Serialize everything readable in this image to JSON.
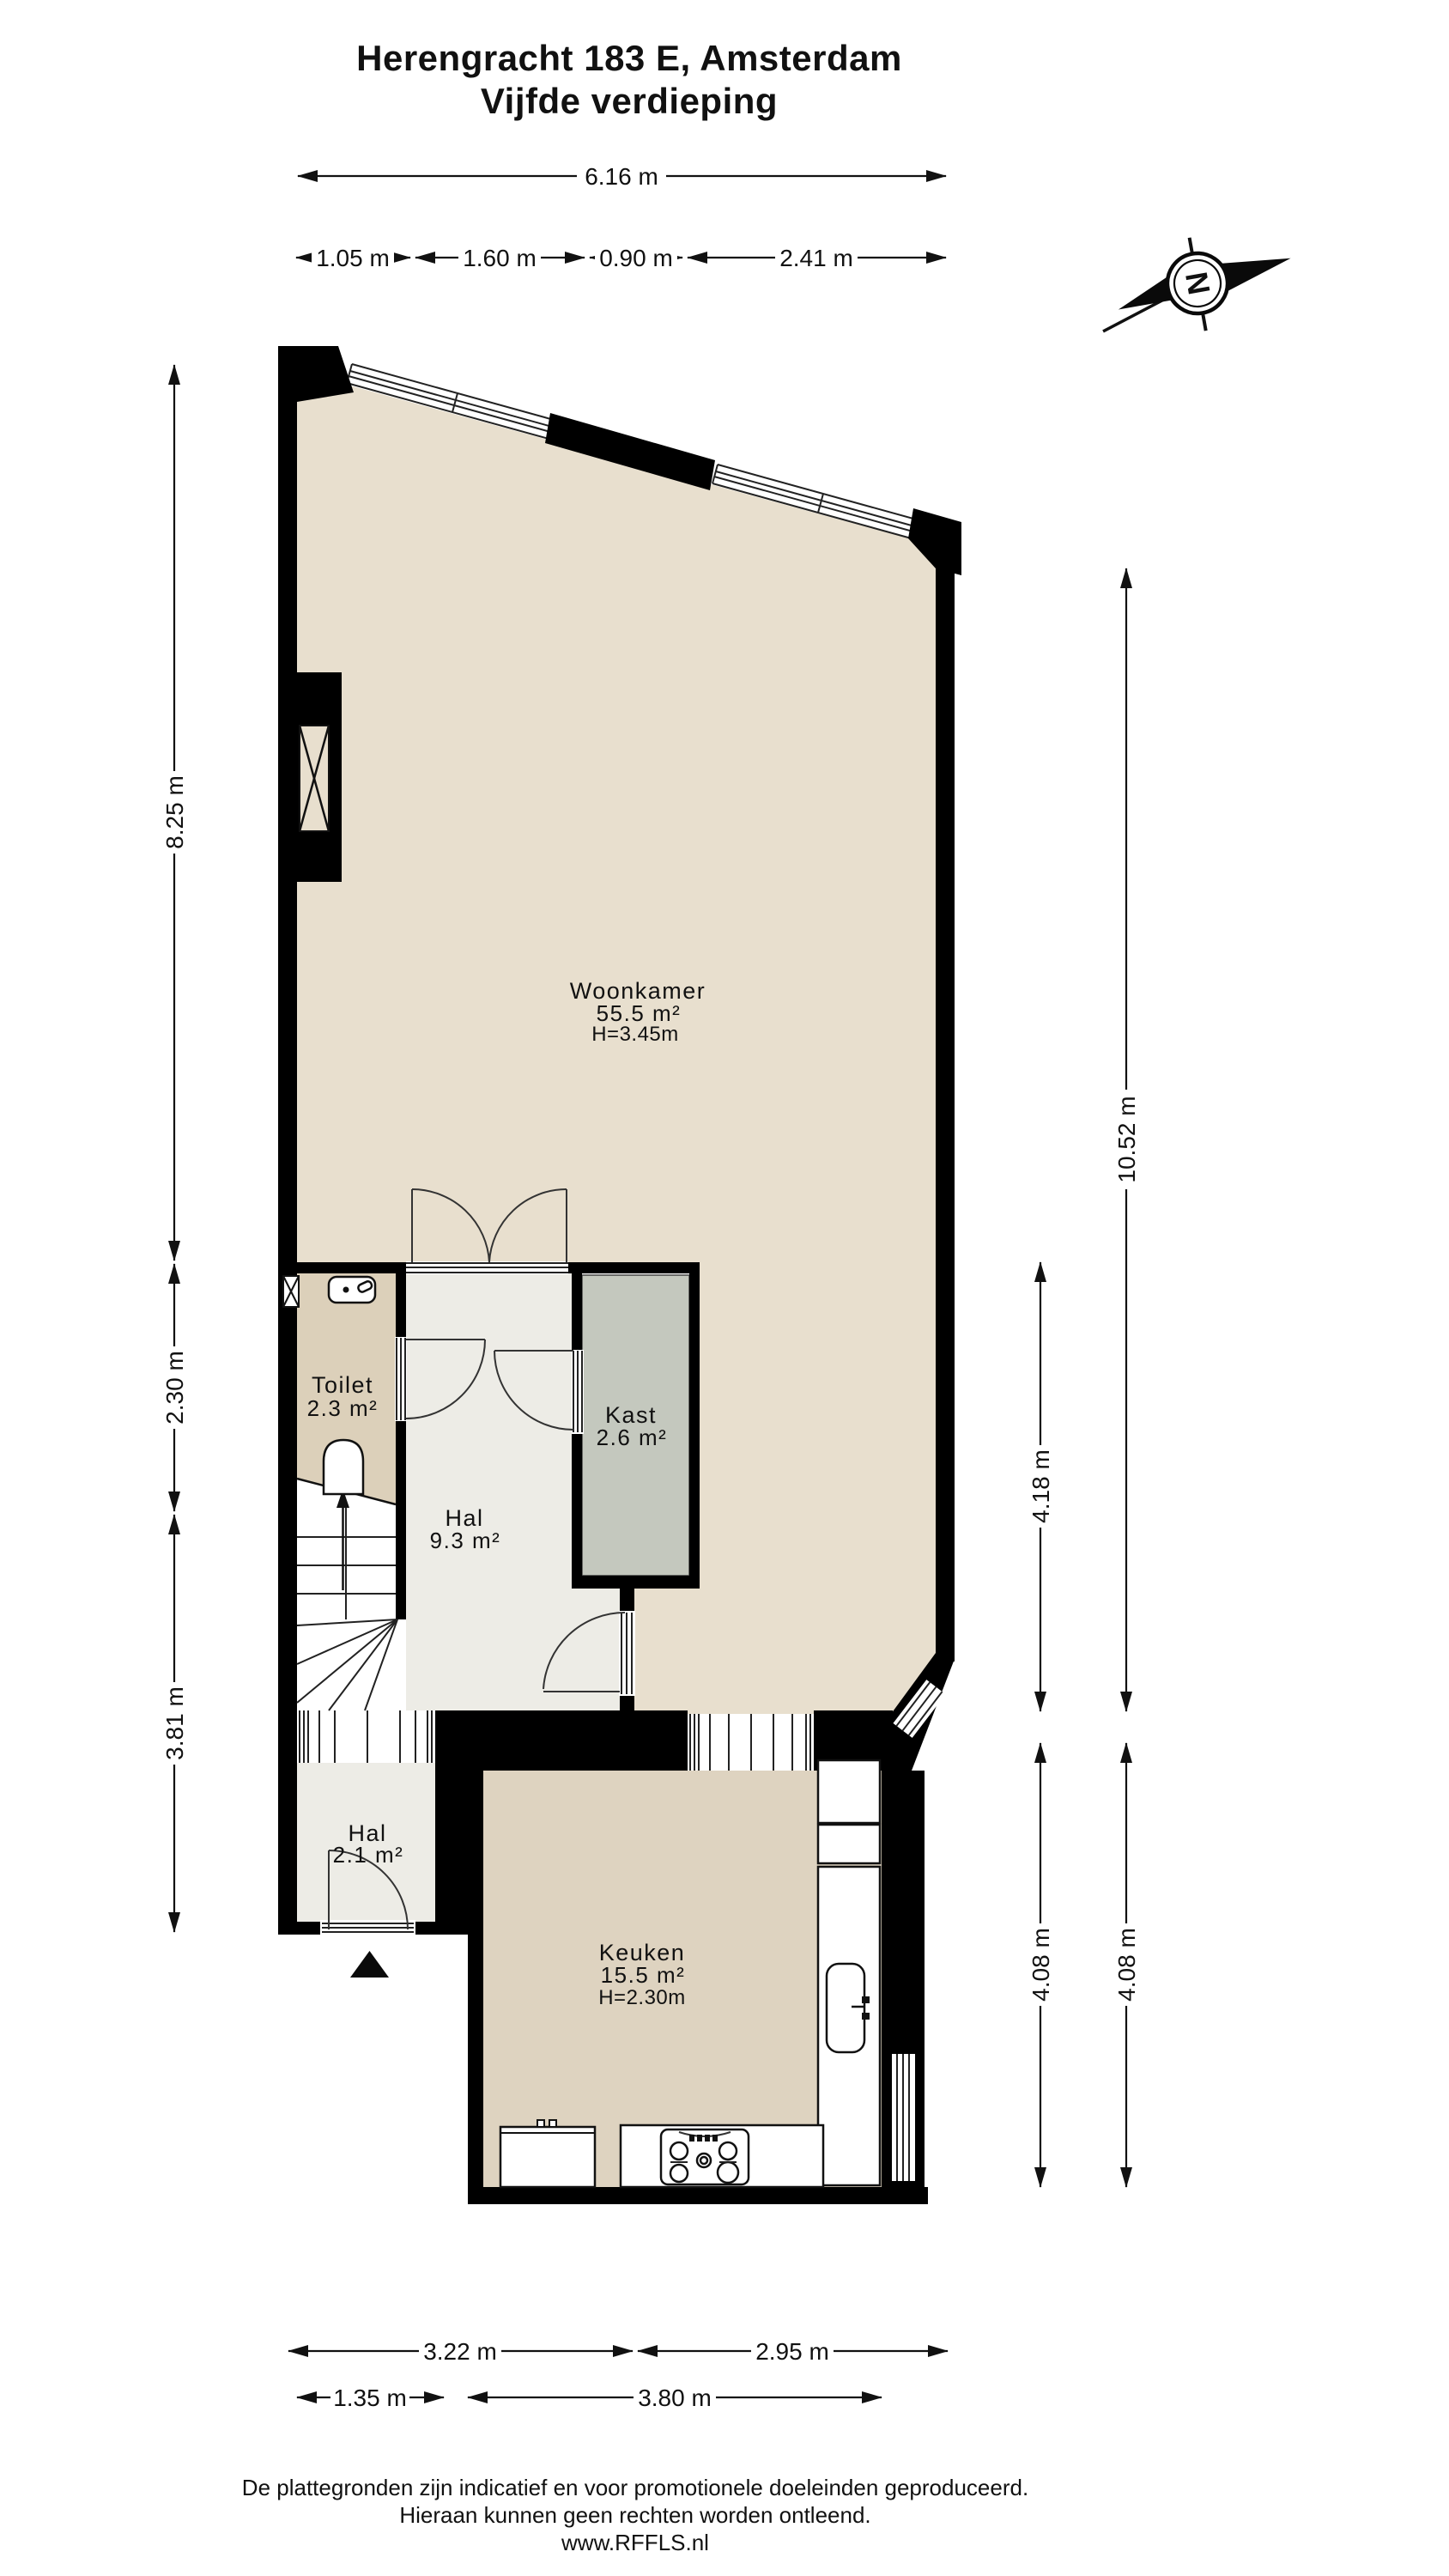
{
  "title": {
    "line1": "Herengracht 183 E, Amsterdam",
    "line2": "Vijfde verdieping"
  },
  "compass": {
    "north_letter": "N"
  },
  "rooms": {
    "woonkamer": {
      "name": "Woonkamer",
      "area": "55.5 m²",
      "ceiling": "H=3.45m"
    },
    "toilet": {
      "name": "Toilet",
      "area": "2.3 m²"
    },
    "kast": {
      "name": "Kast",
      "area": "2.6 m²"
    },
    "hal": {
      "name": "Hal",
      "area": "9.3 m²"
    },
    "hal2": {
      "name": "Hal",
      "area": "2.1 m²"
    },
    "keuken": {
      "name": "Keuken",
      "area": "15.5 m²",
      "ceiling": "H=2.30m"
    }
  },
  "dimensions": {
    "top_total": "6.16 m",
    "top_seg1": "1.05 m",
    "top_seg2": "1.60 m",
    "top_seg3": "0.90 m",
    "top_seg4": "2.41 m",
    "left_top": "8.25 m",
    "left_mid": "2.30 m",
    "left_bottom": "3.81 m",
    "right_total": "10.52 m",
    "right_mid": "4.18 m",
    "right_kitchen_inner": "4.08 m",
    "right_kitchen_outer": "4.08 m",
    "bottom_left": "3.22 m",
    "bottom_right": "2.95 m",
    "bottom_left2": "1.35 m",
    "bottom_right2": "3.80 m"
  },
  "footer": {
    "line1": "De plattegronden zijn indicatief en voor promotionele doeleinden geproduceerd.",
    "line2": "Hieraan kunnen geen rechten worden ontleend.",
    "line3": "www.RFFLS.nl"
  },
  "colors": {
    "wall": "#000000",
    "floor_woonkamer": "#e8dfce",
    "floor_keuken": "#ded3c0",
    "floor_toilet": "#dcd0ba",
    "floor_hal": "#edece6",
    "floor_kast": "#c4c8be",
    "ink": "#111111"
  }
}
